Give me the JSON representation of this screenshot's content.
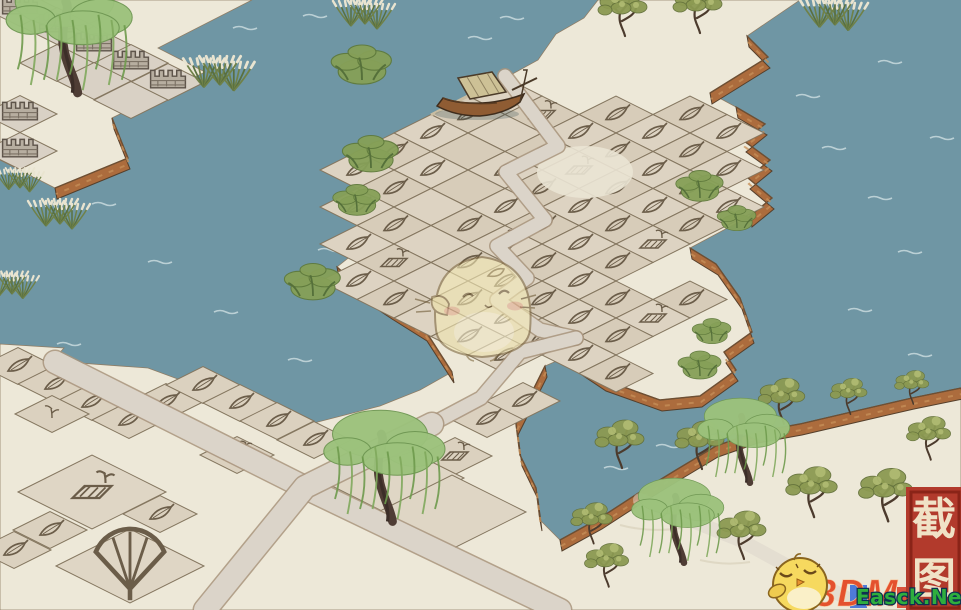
{
  "watermarks": {
    "seal": {
      "chars": [
        "截",
        "图"
      ],
      "bg": "#B23A2C",
      "border": "#8A2418",
      "fg": "#F0E2C6"
    },
    "logo_3dm": {
      "text": "3DM",
      "color": "#E4512E"
    },
    "site": {
      "text": "Easck.Net",
      "color": "#2EAE3E",
      "outline": "#0E3050"
    },
    "mascot": "sleepy-chick"
  },
  "scene": {
    "c": {
      "water": "#6F96A4",
      "land": "#EDE8D8",
      "tile_a": "#DDD3C2",
      "tile_b": "#D7CCB9",
      "road": "#DBD4C9",
      "cliff": "#AC6C3D",
      "tree_olive": "#8C9A52",
      "tree_willow": "#9CC27C",
      "icon_line": "#6B5D49"
    },
    "ripples": [
      [
        233,
        28
      ],
      [
        303,
        16
      ],
      [
        468,
        38
      ],
      [
        500,
        18
      ],
      [
        92,
        204
      ],
      [
        148,
        262
      ],
      [
        214,
        312
      ],
      [
        57,
        344
      ],
      [
        288,
        360
      ],
      [
        318,
        250
      ],
      [
        822,
        148
      ],
      [
        868,
        198
      ],
      [
        898,
        252
      ],
      [
        848,
        310
      ],
      [
        908,
        355
      ],
      [
        930,
        138
      ],
      [
        878,
        62
      ],
      [
        796,
        96
      ],
      [
        604,
        468
      ],
      [
        656,
        446
      ]
    ],
    "land_topleft": [
      [
        0,
        0
      ],
      [
        252,
        0
      ],
      [
        158,
        48
      ],
      [
        205,
        72
      ],
      [
        112,
        118
      ],
      [
        128,
        158
      ],
      [
        55,
        188
      ],
      [
        0,
        160
      ]
    ],
    "land_main": [
      [
        431,
        115
      ],
      [
        468,
        96
      ],
      [
        505,
        78
      ],
      [
        538,
        60
      ],
      [
        556,
        34
      ],
      [
        584,
        18
      ],
      [
        598,
        0
      ],
      [
        800,
        0
      ],
      [
        747,
        36
      ],
      [
        768,
        57
      ],
      [
        710,
        93
      ],
      [
        736,
        107
      ],
      [
        765,
        124
      ],
      [
        744,
        141
      ],
      [
        770,
        160
      ],
      [
        748,
        178
      ],
      [
        772,
        198
      ],
      [
        750,
        216
      ],
      [
        690,
        248
      ],
      [
        716,
        264
      ],
      [
        740,
        298
      ],
      [
        752,
        332
      ],
      [
        724,
        352
      ],
      [
        736,
        370
      ],
      [
        700,
        396
      ],
      [
        660,
        400
      ],
      [
        604,
        380
      ],
      [
        568,
        356
      ],
      [
        545,
        366
      ],
      [
        532,
        392
      ],
      [
        516,
        424
      ],
      [
        520,
        455
      ],
      [
        536,
        488
      ],
      [
        540,
        520
      ],
      [
        560,
        540
      ],
      [
        600,
        518
      ],
      [
        640,
        492
      ],
      [
        676,
        470
      ],
      [
        716,
        446
      ],
      [
        756,
        432
      ],
      [
        800,
        424
      ],
      [
        860,
        410
      ],
      [
        912,
        398
      ],
      [
        961,
        388
      ],
      [
        961,
        610
      ],
      [
        0,
        610
      ],
      [
        0,
        344
      ],
      [
        64,
        348
      ],
      [
        52,
        361
      ],
      [
        148,
        368
      ],
      [
        205,
        389
      ],
      [
        310,
        424
      ],
      [
        380,
        406
      ],
      [
        420,
        390
      ],
      [
        452,
        372
      ],
      [
        425,
        330
      ],
      [
        390,
        308
      ],
      [
        360,
        288
      ],
      [
        337,
        267
      ],
      [
        362,
        247
      ],
      [
        348,
        232
      ],
      [
        382,
        212
      ],
      [
        368,
        196
      ],
      [
        402,
        176
      ],
      [
        390,
        162
      ],
      [
        412,
        140
      ]
    ],
    "cliffs": [
      [
        [
          112,
          118
        ],
        [
          128,
          158
        ],
        [
          55,
          188
        ]
      ],
      [
        [
          747,
          36
        ],
        [
          768,
          57
        ],
        [
          710,
          93
        ]
      ],
      [
        [
          736,
          107
        ],
        [
          765,
          124
        ],
        [
          744,
          141
        ],
        [
          770,
          160
        ],
        [
          748,
          178
        ],
        [
          772,
          198
        ],
        [
          750,
          216
        ]
      ],
      [
        [
          690,
          248
        ],
        [
          716,
          264
        ],
        [
          740,
          298
        ],
        [
          752,
          332
        ],
        [
          724,
          352
        ],
        [
          736,
          370
        ],
        [
          700,
          396
        ],
        [
          660,
          400
        ],
        [
          604,
          380
        ],
        [
          568,
          356
        ]
      ],
      [
        [
          545,
          366
        ],
        [
          532,
          392
        ],
        [
          516,
          424
        ],
        [
          520,
          455
        ],
        [
          536,
          488
        ],
        [
          540,
          520
        ]
      ],
      [
        [
          560,
          540
        ],
        [
          600,
          518
        ],
        [
          640,
          492
        ],
        [
          676,
          470
        ],
        [
          716,
          446
        ],
        [
          756,
          432
        ],
        [
          800,
          424
        ],
        [
          860,
          410
        ],
        [
          912,
          398
        ],
        [
          961,
          388
        ]
      ],
      [
        [
          337,
          267
        ],
        [
          360,
          288
        ],
        [
          390,
          308
        ],
        [
          425,
          330
        ],
        [
          452,
          372
        ]
      ]
    ],
    "island_tiles": [
      [
        3,
        -2,
        "L"
      ],
      [
        4,
        -2,
        "L"
      ],
      [
        2,
        -1,
        "L"
      ],
      [
        3,
        -1,
        "L"
      ],
      [
        4,
        -1,
        "L"
      ],
      [
        5,
        -1,
        "L"
      ],
      [
        0,
        0,
        "N"
      ],
      [
        1,
        0,
        "F"
      ],
      [
        2,
        0,
        "L"
      ],
      [
        3,
        0,
        "L"
      ],
      [
        4,
        0,
        "L"
      ],
      [
        5,
        0,
        "L"
      ],
      [
        6,
        0,
        "L"
      ],
      [
        0,
        1,
        "L"
      ],
      [
        1,
        1,
        "N"
      ],
      [
        2,
        1,
        "L"
      ],
      [
        3,
        1,
        "F"
      ],
      [
        4,
        1,
        "L"
      ],
      [
        5,
        1,
        "L"
      ],
      [
        6,
        1,
        "L"
      ],
      [
        0,
        2,
        "L"
      ],
      [
        1,
        2,
        "N"
      ],
      [
        2,
        2,
        "L"
      ],
      [
        3,
        2,
        "L"
      ],
      [
        4,
        2,
        "L"
      ],
      [
        5,
        2,
        "L"
      ],
      [
        6,
        2,
        "F"
      ],
      [
        0,
        3,
        "L"
      ],
      [
        1,
        3,
        "L"
      ],
      [
        2,
        3,
        "N"
      ],
      [
        3,
        3,
        "L"
      ],
      [
        4,
        3,
        "L"
      ],
      [
        5,
        3,
        "L"
      ],
      [
        6,
        3,
        "L"
      ],
      [
        8,
        3,
        "L"
      ],
      [
        0,
        4,
        "L"
      ],
      [
        1,
        4,
        "L"
      ],
      [
        2,
        4,
        "N"
      ],
      [
        3,
        4,
        "L"
      ],
      [
        4,
        4,
        "F"
      ],
      [
        5,
        4,
        "L"
      ],
      [
        6,
        4,
        "L"
      ],
      [
        7,
        4,
        "L"
      ],
      [
        8,
        4,
        "F"
      ],
      [
        1,
        5,
        "L"
      ],
      [
        2,
        5,
        "L"
      ],
      [
        3,
        5,
        "N"
      ],
      [
        4,
        5,
        "L"
      ],
      [
        5,
        5,
        "L"
      ],
      [
        6,
        5,
        "L"
      ],
      [
        7,
        5,
        "L"
      ],
      [
        8,
        5,
        "L"
      ],
      [
        2,
        6,
        "L"
      ],
      [
        3,
        6,
        "F"
      ],
      [
        4,
        6,
        "N"
      ],
      [
        5,
        6,
        "L"
      ],
      [
        6,
        6,
        "L"
      ],
      [
        7,
        6,
        "L"
      ],
      [
        8,
        6,
        "L"
      ],
      [
        9,
        6,
        "L"
      ],
      [
        3,
        7,
        "L"
      ],
      [
        4,
        7,
        "L"
      ],
      [
        5,
        7,
        "N"
      ],
      [
        6,
        7,
        "L"
      ],
      [
        7,
        7,
        "L"
      ]
    ],
    "wall_tiles": [
      [
        20,
        8,
        "B"
      ],
      [
        57,
        26,
        "B"
      ],
      [
        94,
        45,
        "B"
      ],
      [
        131,
        63,
        "B"
      ],
      [
        168,
        82,
        "B"
      ],
      [
        20,
        114,
        "B"
      ],
      [
        20,
        151,
        "B"
      ],
      [
        57,
        63,
        "N"
      ],
      [
        94,
        81,
        "N"
      ],
      [
        131,
        100,
        "N"
      ]
    ],
    "ground_tiles": [
      [
        18,
        366,
        1,
        "L"
      ],
      [
        55,
        384,
        1,
        "L"
      ],
      [
        92,
        402,
        1,
        "L"
      ],
      [
        129,
        420,
        1,
        "L"
      ],
      [
        166,
        402,
        1,
        "L"
      ],
      [
        203,
        385,
        1,
        "L"
      ],
      [
        240,
        403,
        1,
        "L"
      ],
      [
        277,
        421,
        1,
        "L"
      ],
      [
        314,
        440,
        1,
        "L"
      ],
      [
        160,
        514,
        1,
        "L"
      ],
      [
        50,
        530,
        1,
        "L"
      ],
      [
        14,
        550,
        1,
        "L"
      ],
      [
        487,
        419,
        1,
        "L"
      ],
      [
        523,
        401,
        1,
        "L"
      ],
      [
        237,
        455,
        1,
        "F"
      ],
      [
        455,
        456,
        1,
        "F"
      ],
      [
        52,
        414,
        1,
        "S"
      ],
      [
        92,
        492,
        2,
        "F"
      ],
      [
        130,
        566,
        2,
        "X"
      ],
      [
        390,
        478,
        2,
        "N"
      ],
      [
        452,
        512,
        2,
        "N"
      ]
    ],
    "roads": [
      {
        "w": 13,
        "pts": [
          [
            505,
            76
          ],
          [
            558,
            146
          ],
          [
            506,
            172
          ],
          [
            545,
            220
          ],
          [
            497,
            246
          ],
          [
            527,
            278
          ],
          [
            497,
            300
          ],
          [
            540,
            330
          ],
          [
            576,
            338
          ]
        ]
      },
      {
        "w": 13,
        "pts": [
          [
            576,
            338
          ],
          [
            520,
            352
          ],
          [
            481,
            398
          ],
          [
            432,
            424
          ]
        ]
      },
      {
        "w": 22,
        "pts": [
          [
            55,
            362
          ],
          [
            310,
            490
          ],
          [
            560,
            610
          ]
        ]
      },
      {
        "w": 22,
        "pts": [
          [
            432,
            424
          ],
          [
            305,
            487
          ],
          [
            205,
            610
          ]
        ]
      },
      {
        "w": 14,
        "faint": true,
        "pts": [
          [
            640,
            500
          ],
          [
            740,
            540
          ],
          [
            850,
            600
          ]
        ]
      }
    ],
    "trees": [
      [
        "r",
        220,
        85,
        1.15
      ],
      [
        "r",
        365,
        24,
        1
      ],
      [
        "r",
        60,
        224,
        1
      ],
      [
        "r",
        12,
        294,
        0.9
      ],
      [
        "r",
        20,
        188,
        0.8
      ],
      [
        "r",
        835,
        25,
        1.1
      ],
      [
        "b",
        362,
        80,
        1.4
      ],
      [
        "b",
        371,
        168,
        1.3
      ],
      [
        "b",
        357,
        212,
        1.1
      ],
      [
        "b",
        313,
        296,
        1.3
      ],
      [
        "b",
        700,
        198,
        1.1
      ],
      [
        "b",
        737,
        228,
        0.9
      ],
      [
        "b",
        712,
        341,
        0.9
      ],
      [
        "b",
        700,
        376,
        1
      ],
      [
        "w",
        75,
        85,
        1.3
      ],
      [
        "w",
        390,
        514,
        1.25
      ],
      [
        "w",
        748,
        477,
        0.95
      ],
      [
        "w",
        682,
        557,
        0.95
      ],
      [
        "o",
        623,
        33,
        1
      ],
      [
        "o",
        698,
        30,
        1
      ],
      [
        "o",
        620,
        465,
        1
      ],
      [
        "o",
        700,
        466,
        1
      ],
      [
        "o",
        782,
        421,
        0.95
      ],
      [
        "o",
        812,
        514,
        1.05
      ],
      [
        "o",
        742,
        556,
        1
      ],
      [
        "o",
        592,
        541,
        0.85
      ],
      [
        "o",
        607,
        584,
        0.9
      ],
      [
        "o",
        886,
        518,
        1.1
      ],
      [
        "o",
        929,
        457,
        0.9
      ],
      [
        "o",
        849,
        412,
        0.75
      ],
      [
        "o",
        912,
        402,
        0.7
      ]
    ],
    "boat": [
      437,
      86
    ]
  }
}
